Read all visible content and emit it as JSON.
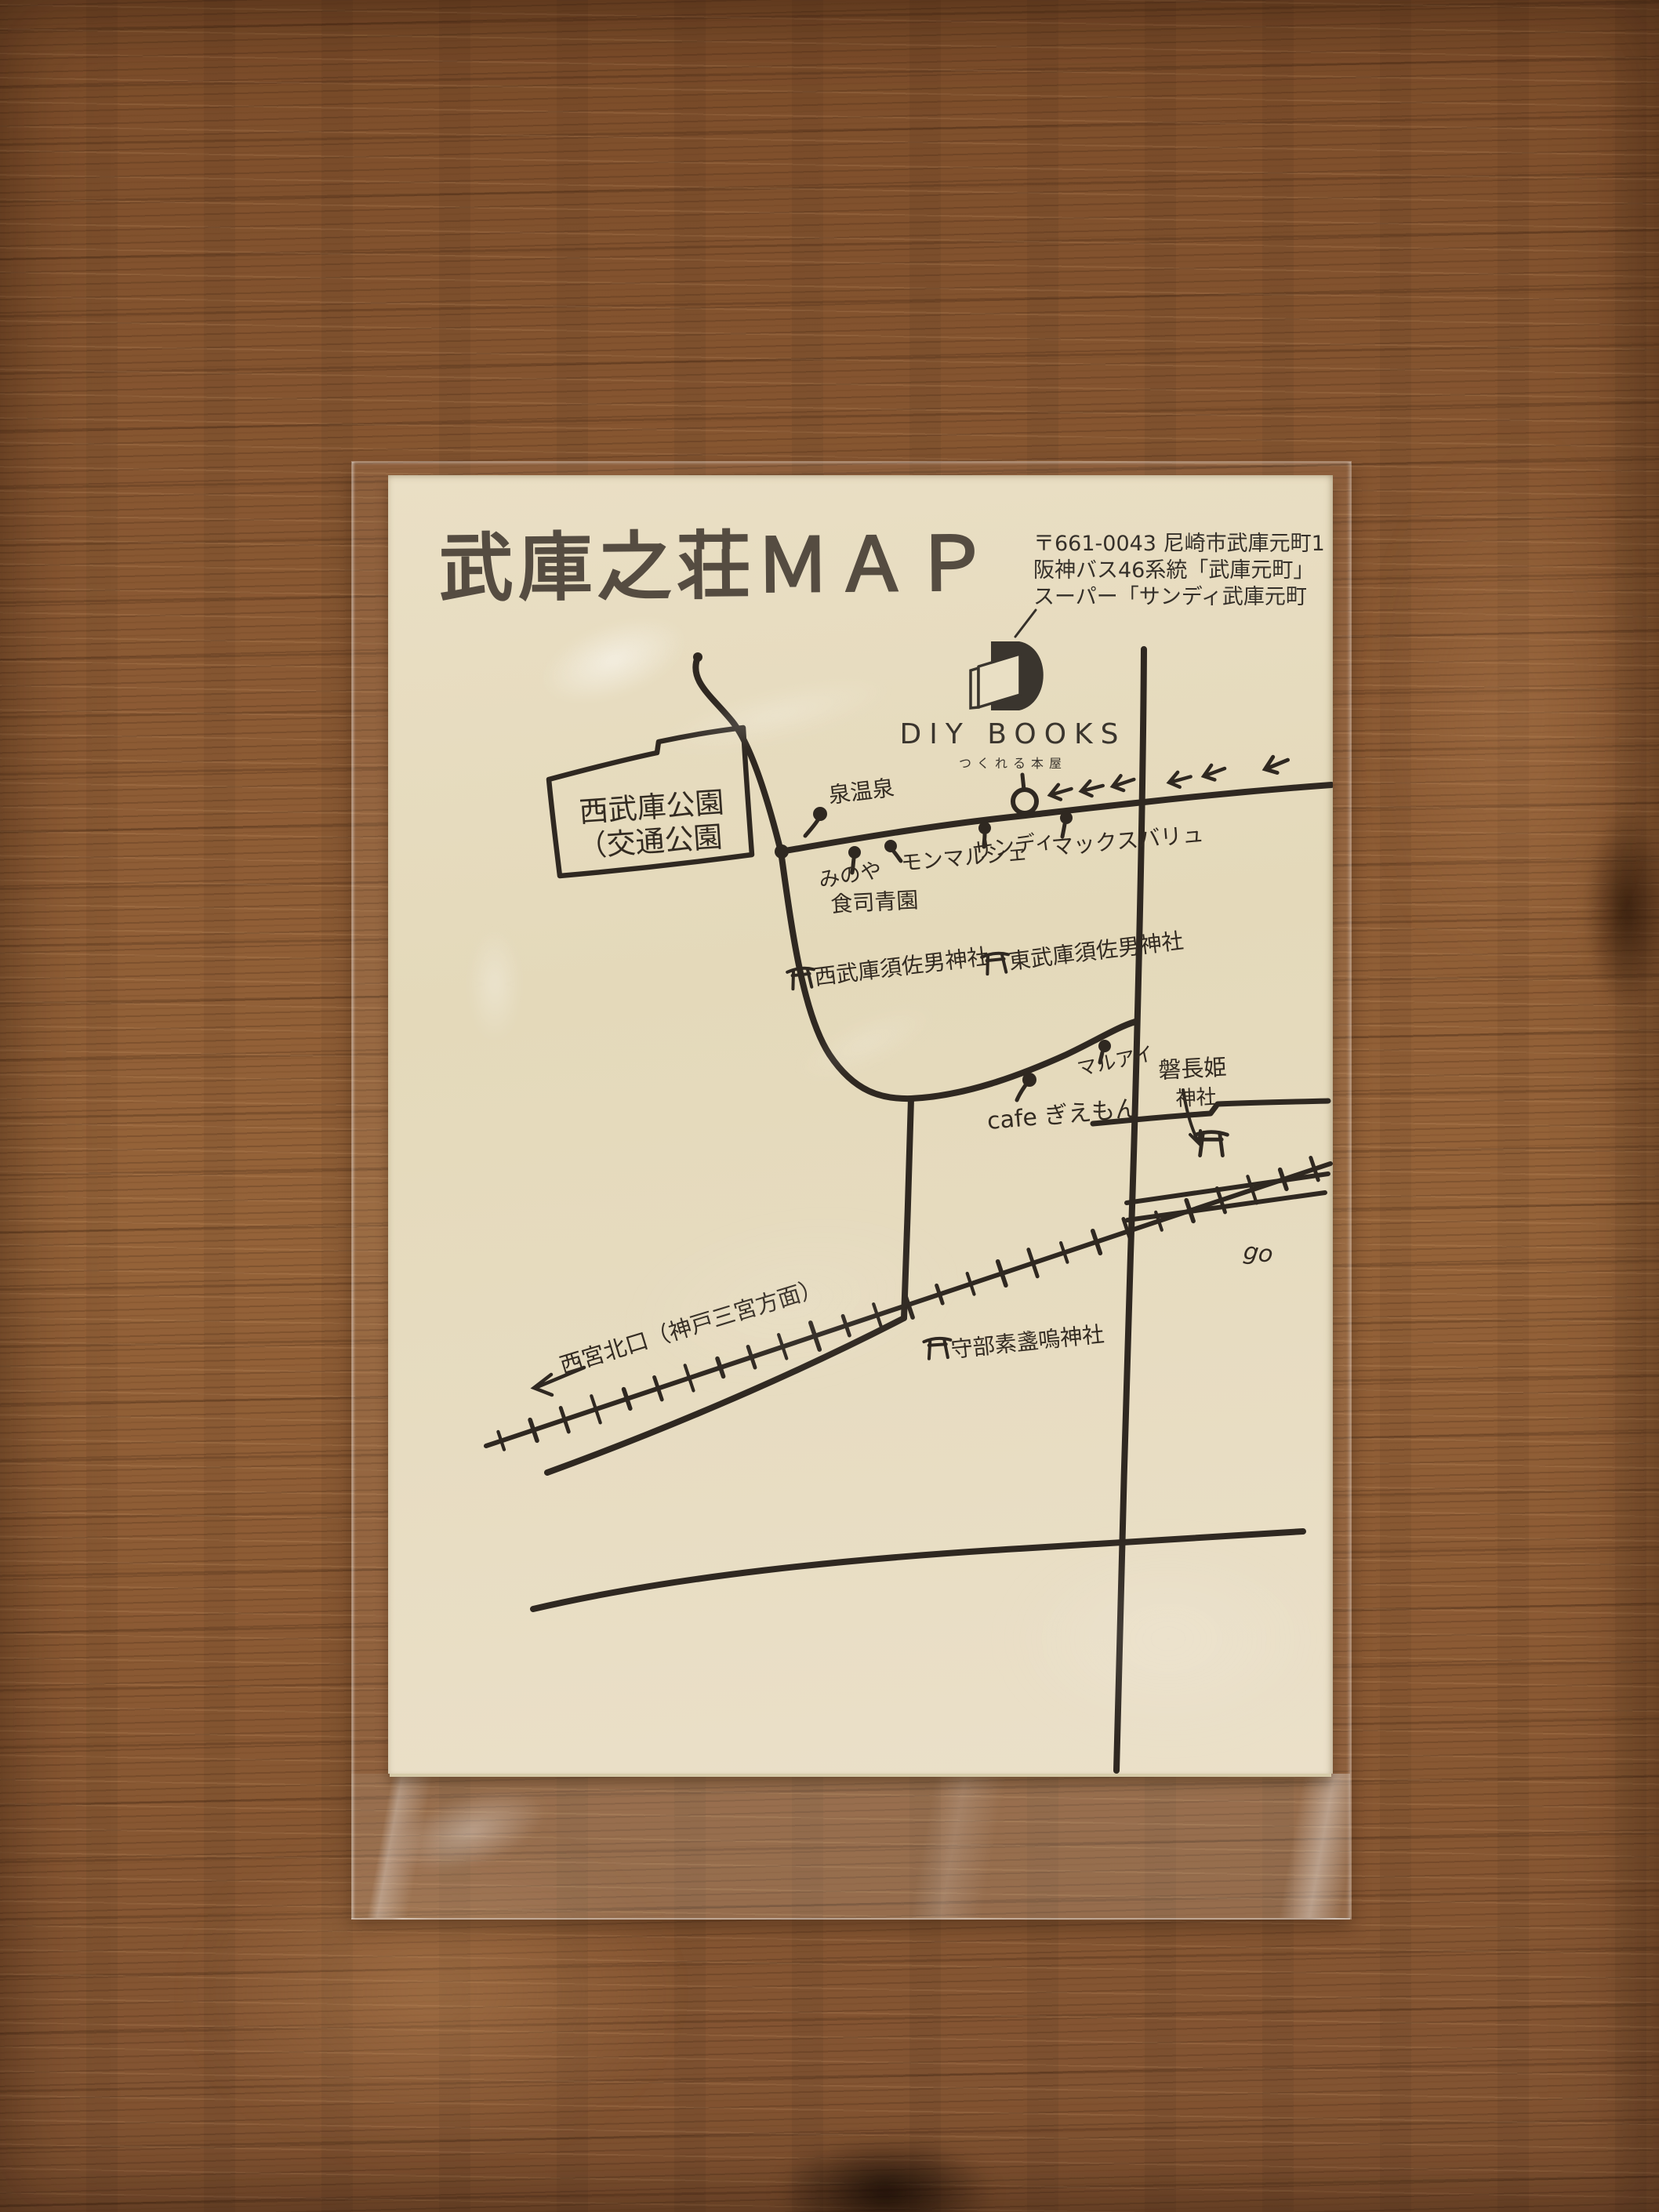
{
  "colors": {
    "wood_table": "#8a5933",
    "paper": "#e7dcc2",
    "ink": "#2f2821",
    "printed_text": "#35302a"
  },
  "icons": {
    "location_pin": "teardrop-pin",
    "torii_gate": "torii",
    "left_arrow": "←",
    "shop_marker_circle": "○",
    "diy_books_logo": "black-D-with-open-book"
  },
  "paper": {
    "title": "武庫之荘ＭＡＰ",
    "address": {
      "line1": "〒661-0043 尼崎市武庫元町1",
      "line2": "阪神バス46系統「武庫元町」",
      "line3": "スーパー「サンディ武庫元町"
    },
    "logo": {
      "name": "DIY BOOKS",
      "tagline": "つくれる本屋"
    },
    "labels": {
      "park1": "西武庫公園",
      "park2": "（交通公園",
      "onsen": "泉温泉",
      "minoya1": "みのや",
      "minoya2": "食司青園",
      "monmarche": "モンマルシェ",
      "sandy": "サンディ",
      "maxvalu": "マックスバリュ",
      "shrine_nishi": "西武庫須佐男神社",
      "shrine_higashi": "東武庫須佐男神社",
      "cafe": "cafe ぎえもん",
      "maruai": "マルアイ",
      "iwanaga1": "磐長姫",
      "iwanaga2": "神社",
      "moribe": "守部素盞嗚神社",
      "station": "西宮北口（神戸三宮方面）",
      "edge_partial": "go"
    }
  }
}
